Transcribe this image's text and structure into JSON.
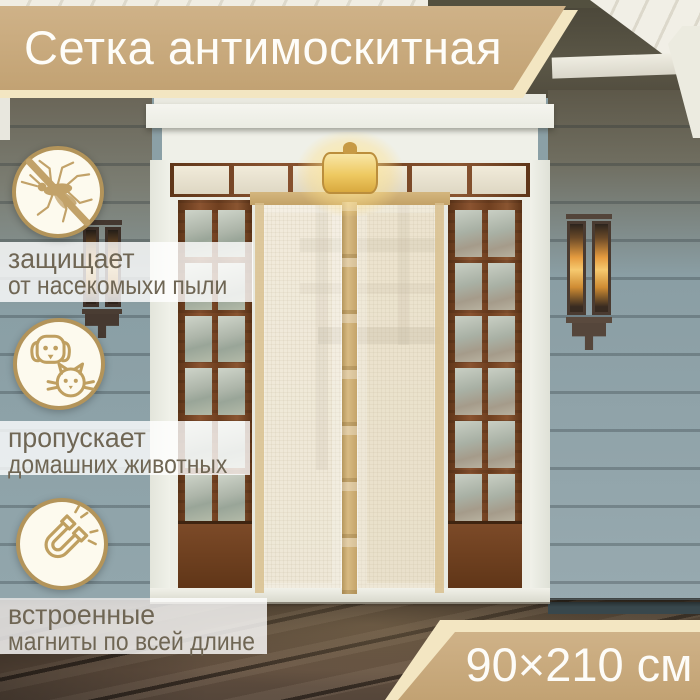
{
  "banner": {
    "title": "Сетка антимоскитная"
  },
  "features": [
    {
      "icon": "no-mosquito-icon",
      "lines": [
        "защищает",
        "от насекомыхи пыли"
      ]
    },
    {
      "icon": "pets-icon",
      "lines": [
        "пропускает",
        "домашних животных"
      ]
    },
    {
      "icon": "magnet-icon",
      "lines": [
        "встроенные",
        "магниты по всей длине"
      ]
    }
  ],
  "size_label": {
    "text": "90×210 см"
  },
  "colors": {
    "banner_tan": "#c6a87c",
    "banner_cream": "#f3e6c2",
    "icon_gold": "#bf9f60",
    "feature_text": "#6f6654",
    "mesh_beige": "#e8dfc6",
    "siding_blue_gray": "#8ba0a6",
    "wood_frame": "#7c4a2c",
    "deck_brown": "#4d3f31"
  }
}
